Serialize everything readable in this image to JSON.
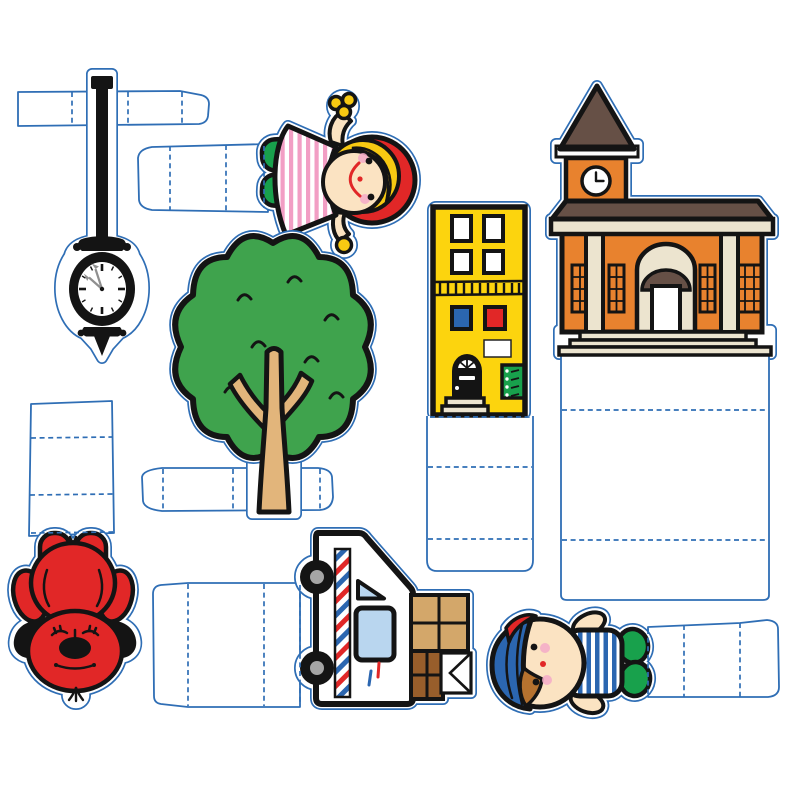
{
  "sheet": {
    "kind": "paper-craft-cutout-sheet",
    "description": "Printable neighborhood play-set page with eight stand-up cutout figures, each attached to white fold-tab base strips with blue dashed fold lines",
    "width_px": 800,
    "height_px": 800,
    "background": "#ffffff"
  },
  "palette": {
    "cutline": "#2f6eb5",
    "ink": "#141414",
    "red": "#e12727",
    "green": "#18a14c",
    "leaf": "#3fa34d",
    "trunk": "#e2b57b",
    "yellow": "#fcd40e",
    "blue": "#2b66b0",
    "lightblue": "#b9d6ef",
    "skin": "#fbe3c2",
    "blonde": "#f7c912",
    "pink": "#f29ec4",
    "orange": "#e8822e",
    "roof": "#665046",
    "eave": "#4b3a31",
    "cream": "#ece4cf",
    "tan": "#d3a76a",
    "brown": "#985e2b",
    "hair": "#b5722f",
    "gray": "#a5a5a5",
    "cheek": "#f3aac8",
    "hand": "#8f8f8f",
    "paper": "#ffffff"
  },
  "pieces": [
    {
      "id": "street-clock",
      "label": "black street post clock",
      "clock_time": "10:55",
      "base": "horizontal fold strip, 3 fold lines"
    },
    {
      "id": "girl",
      "label": "girl in red hood and pink striped dress",
      "base": "horizontal fold strip, 3 fold lines"
    },
    {
      "id": "tree",
      "label": "green tree",
      "base": "horizontal fold strip behind trunk, 3 fold lines"
    },
    {
      "id": "townhouse",
      "label": "yellow townhouse with black door and buzzer panel",
      "base": "attached fold panel, 3 fold lines"
    },
    {
      "id": "schoolhouse",
      "label": "orange schoolhouse with clock tower and columns",
      "clock_time": "3:00",
      "base": "attached fold panel, 3 fold lines"
    },
    {
      "id": "red-dog",
      "label": "big red dog (upside down)",
      "base": "vertical fold strip, 3 fold lines"
    },
    {
      "id": "mail-truck",
      "label": "mail truck with parcels and envelope (rotated)",
      "base": "horizontal fold strip, 3 fold lines"
    },
    {
      "id": "boy",
      "label": "boy in blue cap and striped shirt (rotated)",
      "base": "horizontal fold strip, 3 fold lines"
    }
  ]
}
